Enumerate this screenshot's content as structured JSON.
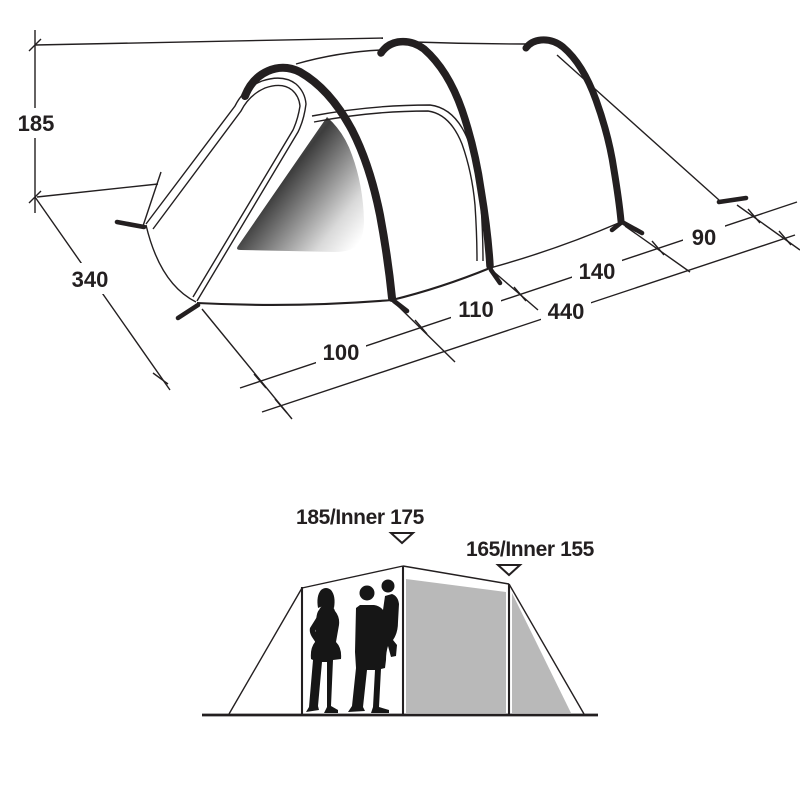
{
  "top_view": {
    "description": "3D perspective drawing of tunnel tent with outer dimensions in cm",
    "dim_height_cm": "185",
    "dim_width_cm": "340",
    "dim_porch_cm": "100",
    "dim_section1_cm": "110",
    "dim_length_cm": "440",
    "dim_section2_cm": "140",
    "dim_section3_cm": "90"
  },
  "front_view": {
    "description": "Front elevation of tent with adult and child silhouettes for scale",
    "peak_height_label": "185/Inner 175",
    "rear_height_label": "165/Inner 155"
  },
  "icons": {
    "marker": "down-triangle-marker"
  },
  "colors": {
    "ink": "#231f20",
    "panel_gray": "#b9b9b9",
    "window_dark": "#3d3d3d",
    "background": "#ffffff"
  }
}
